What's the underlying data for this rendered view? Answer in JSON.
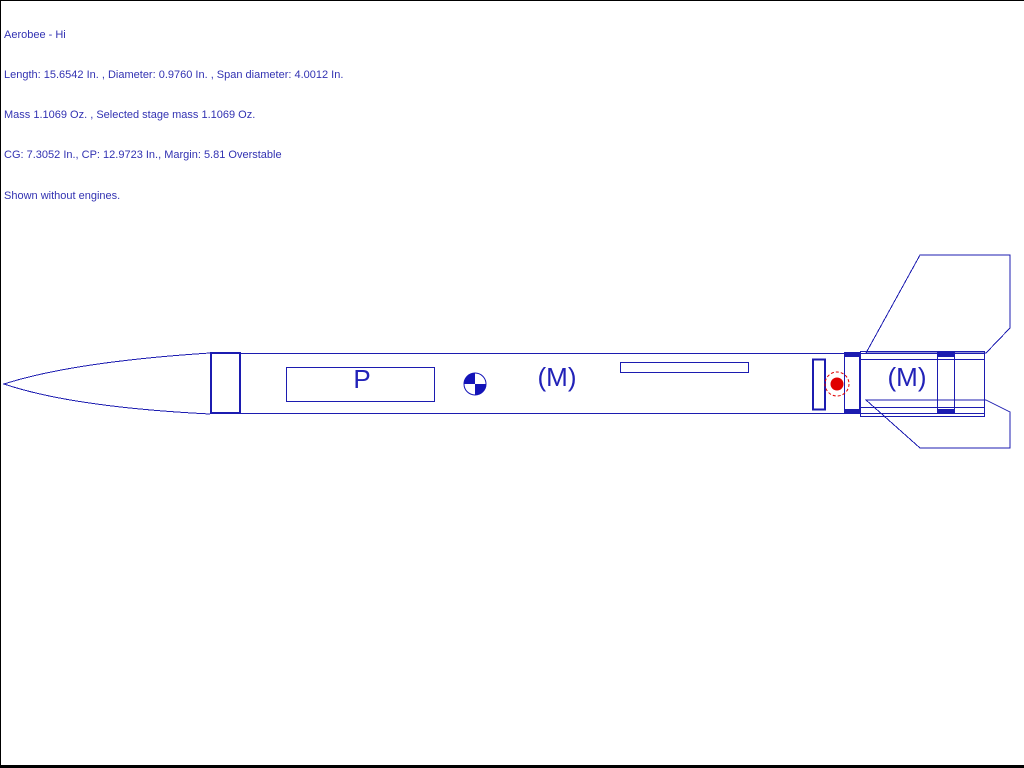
{
  "window": {
    "background": "#ffffff",
    "border_color": "#000000"
  },
  "header": {
    "text_color": "#3232b2",
    "lines": [
      "Aerobee - Hi",
      "Length: 15.6542 In. , Diameter: 0.9760 In. , Span diameter: 4.0012 In.",
      "Mass 1.1069 Oz. , Selected stage mass 1.1069 Oz.",
      "CG: 7.3052 In., CP: 12.9723 In., Margin: 5.81 Overstable",
      "Shown without engines."
    ]
  },
  "rocket_stats": {
    "name": "Aerobee - Hi",
    "length": "15.6542 In.",
    "diameter": "0.9760 In.",
    "span_diameter": "4.0012 In.",
    "mass": "1.1069 Oz.",
    "selected_stage_mass": "1.1069 Oz.",
    "cg": "7.3052 In.",
    "cp": "12.9723 In.",
    "margin": "5.81",
    "stability": "Overstable",
    "engines_note": "Shown without engines."
  },
  "diagram": {
    "labels": {
      "parachute": "P",
      "mass_object_forward": "(M)",
      "mass_object_aft": "(M)"
    },
    "icons": {
      "cg_marker": "quadrant-checkered-circle",
      "cp_marker": "red-dot-in-dashed-circle"
    },
    "colors": {
      "outline_blue": "#1c1cb0",
      "label_blue": "#2222b8",
      "cg_fill_blue": "#1414b8",
      "cp_red": "#e00000"
    }
  }
}
